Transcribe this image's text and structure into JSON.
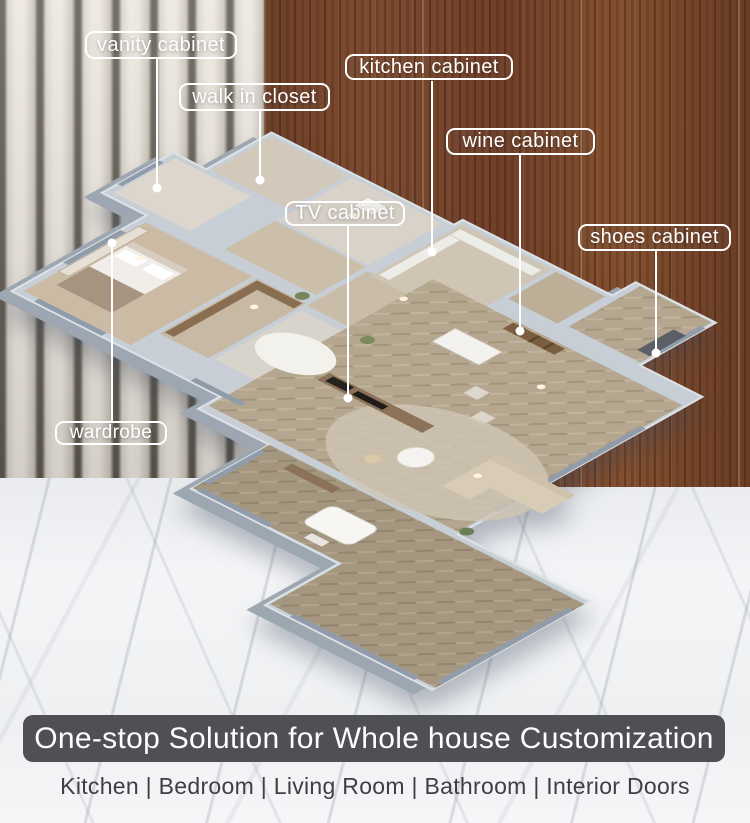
{
  "callouts": [
    {
      "id": "vanity-cabinet",
      "text": "vanity cabinet"
    },
    {
      "id": "walk-in-closet",
      "text": "walk in closet"
    },
    {
      "id": "kitchen-cabinet",
      "text": "kitchen cabinet"
    },
    {
      "id": "wine-cabinet",
      "text": "wine cabinet"
    },
    {
      "id": "tv-cabinet",
      "text": "TV cabinet"
    },
    {
      "id": "shoes-cabinet",
      "text": "shoes cabinet"
    },
    {
      "id": "wardrobe",
      "text": "wardrobe"
    }
  ],
  "banner": {
    "title": "One-stop Solution for Whole house Customization"
  },
  "footer": {
    "categories": "Kitchen | Bedroom | Living Room | Bathroom | Interior Doors"
  },
  "colors": {
    "label_border": "#ffffff",
    "banner_bg": "#4f5054",
    "wall": "#c7ced6",
    "wall_side": "#9ca7b2",
    "wood_accent": "#7a4a31",
    "marble": "#f3f4f6"
  }
}
